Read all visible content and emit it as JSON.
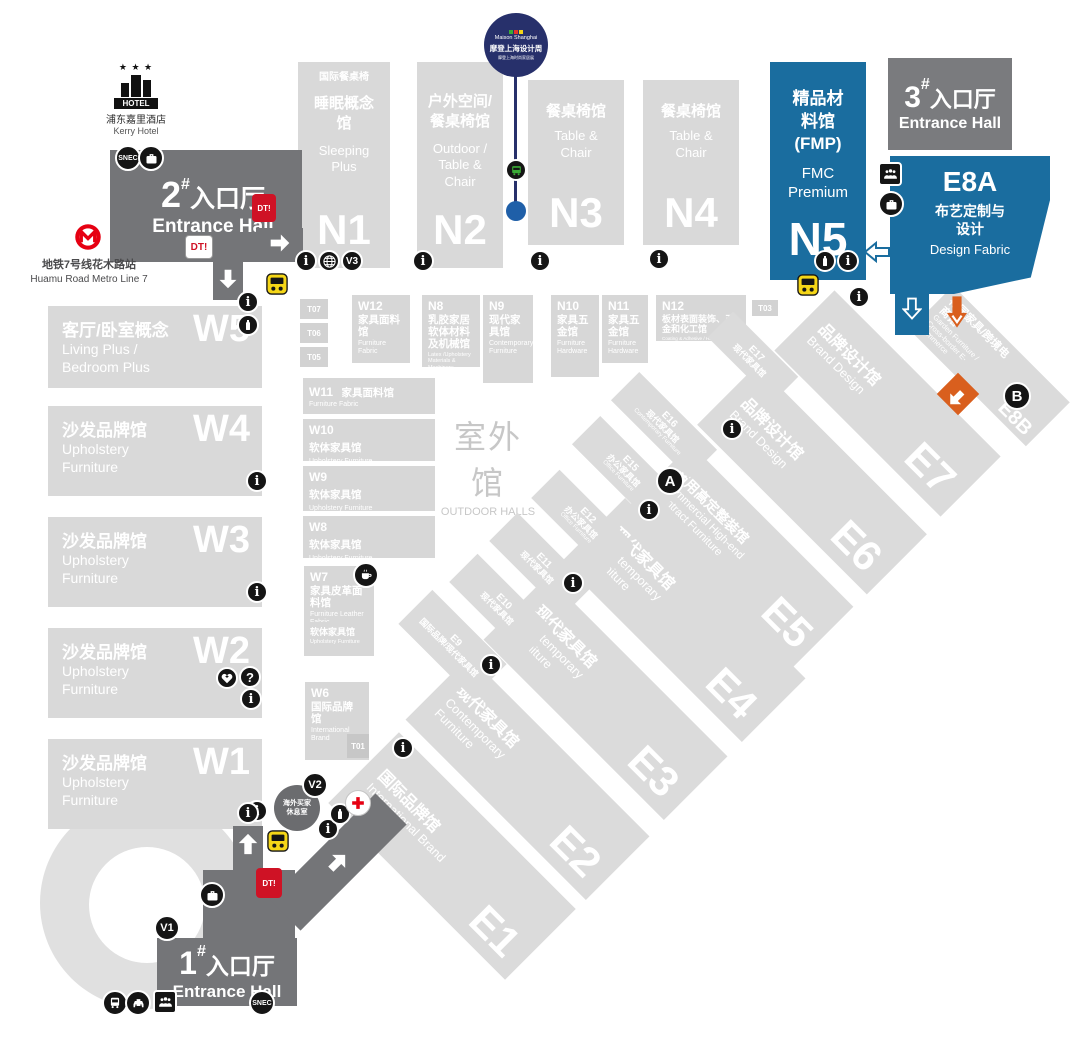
{
  "landmarks": {
    "hotel": {
      "sign": "HOTEL",
      "cn": "浦东嘉里酒店",
      "en": "Kerry Hotel"
    },
    "metro": {
      "cn": "地铁7号线花木路站",
      "en": "Huamu Road Metro Line 7"
    },
    "maison": {
      "brand": "Maison Shanghai",
      "cn": "摩登上海设计周",
      "sub": "摩登上海时尚家居展"
    },
    "outdoor": {
      "cn": "室外馆",
      "en": "OUTDOOR HALLS"
    },
    "lounge": {
      "cn": "海外买家休息室"
    }
  },
  "entrances": {
    "no1": {
      "num": "1",
      "sup": "#",
      "cn": "入口厅",
      "en": "Entrance Hall"
    },
    "no2": {
      "num": "2",
      "sup": "#",
      "cn": "入口厅",
      "en": "Entrance Hall"
    },
    "no3": {
      "num": "3",
      "sup": "#",
      "cn": "入口厅",
      "en": "Entrance Hall"
    }
  },
  "halls": {
    "W1": {
      "id": "W1",
      "cn": "沙发品牌馆",
      "en": "Upholstery Furniture"
    },
    "W2": {
      "id": "W2",
      "cn": "沙发品牌馆",
      "en": "Upholstery Furniture"
    },
    "W3": {
      "id": "W3",
      "cn": "沙发品牌馆",
      "en": "Upholstery Furniture"
    },
    "W4": {
      "id": "W4",
      "cn": "沙发品牌馆",
      "en": "Upholstery Furniture"
    },
    "W5": {
      "id": "W5",
      "cn": "客厅/卧室概念",
      "en": "Living Plus / Bedroom Plus"
    },
    "W6": {
      "id": "W6",
      "cn": "国际品牌馆",
      "en": "International Brand"
    },
    "W7": {
      "id": "W7",
      "cn": "家具皮革面料馆",
      "en": "Furniture Leather Fabric"
    },
    "W7b": {
      "cn": "软体家具馆",
      "en": "Upholstery Furniture"
    },
    "W8": {
      "id": "W8",
      "cn": "软体家具馆",
      "en": "Upholstery Furniture"
    },
    "W9": {
      "id": "W9",
      "cn": "软体家具馆",
      "en": "Upholstery Furniture"
    },
    "W10": {
      "id": "W10",
      "cn": "软体家具馆",
      "en": "Upholstery Furniture"
    },
    "W11": {
      "id": "W11",
      "cn": "家具面料馆",
      "en": "Furniture Fabric"
    },
    "W12": {
      "id": "W12",
      "cn": "家具面料馆",
      "en": "Furniture Fabric"
    },
    "N1": {
      "id": "N1",
      "top": "国际餐桌椅",
      "cn": "睡眠概念馆",
      "en": "Sleeping Plus"
    },
    "N2": {
      "id": "N2",
      "cn": "户外空间/餐桌椅馆",
      "en": "Outdoor / Table & Chair"
    },
    "N3": {
      "id": "N3",
      "cn": "餐桌椅馆",
      "en": "Table & Chair"
    },
    "N4": {
      "id": "N4",
      "cn": "餐桌椅馆",
      "en": "Table & Chair"
    },
    "N5": {
      "id": "N5",
      "cn": "精品材料馆",
      "sub": "(FMP)",
      "en": "FMC Premium"
    },
    "N8": {
      "id": "N8",
      "cn": "乳胶家居软体材料及机械馆",
      "en": "Latex /Upholstery Materials & Machinery"
    },
    "N9": {
      "id": "N9",
      "cn": "现代家具馆",
      "en": "Contemporary Furniture"
    },
    "N10": {
      "id": "N10",
      "cn": "家具五金馆",
      "en": "Furniture Hardware"
    },
    "N11": {
      "id": "N11",
      "cn": "家具五金馆",
      "en": "Furniture Hardware"
    },
    "N12": {
      "id": "N12",
      "cn": "板材表面装饰、五金和化工馆",
      "en": "Coating & Adhesive / Hardware / Panels & Surface Décor"
    },
    "E1": {
      "id": "E1",
      "cn": "国际品牌馆",
      "en": "International Brand"
    },
    "E2": {
      "id": "E2",
      "cn": "现代家具馆",
      "en": "Contemporary Furniture"
    },
    "E3": {
      "id": "E3",
      "cn": "现代家具馆",
      "en": "Contemporary Furniture"
    },
    "E4": {
      "id": "E4",
      "cn": "现代家具馆",
      "en": "Contemporary Furniture"
    },
    "E5": {
      "id": "E5",
      "cn": "商用高定整装馆",
      "en": "Commercial High-end Contract Furniture"
    },
    "E6": {
      "id": "E6",
      "cn": "品牌设计馆",
      "en": "Brand Design"
    },
    "E7": {
      "id": "E7",
      "cn": "品牌设计馆",
      "en": "Brand Design"
    },
    "E8A": {
      "id": "E8A",
      "cn": "布艺定制与设计",
      "en": "Design Fabric"
    },
    "E8B": {
      "id": "E8B",
      "cn": "花园家具/跨境电商馆",
      "en": "Garden Furniture / Cross-border E-commerce"
    },
    "E9": {
      "id": "E9",
      "cn": "国际品牌/现代家具馆",
      "en": ""
    },
    "E10": {
      "id": "E10",
      "cn": "现代家具馆",
      "en": ""
    },
    "E11": {
      "id": "E11",
      "cn": "现代家具馆",
      "en": ""
    },
    "E12": {
      "id": "E12",
      "cn": "办公家具馆",
      "en": "Office Furniture"
    },
    "E15": {
      "id": "E15",
      "cn": "办公家具馆",
      "en": "Office Furniture"
    },
    "E16": {
      "id": "E16",
      "cn": "现代家具馆",
      "en": "Contemporary Furniture"
    },
    "E17": {
      "id": "E17",
      "cn": "现代家具馆",
      "en": ""
    }
  },
  "service_boxes": {
    "t07": "T07",
    "t06": "T06",
    "t05": "T05",
    "t03": "T03",
    "t01": "T01"
  },
  "badges": {
    "snec": "SNEC",
    "dt": "DT!",
    "v1": "V1",
    "v2": "V2",
    "v3": "V3",
    "a": "A",
    "b": "B",
    "info": "i",
    "question": "?"
  },
  "colors": {
    "hall_gray": "#d9d9d9",
    "teal": "#4aa3a8",
    "blue": "#1a6d9f",
    "dark_gray": "#747578",
    "navy": "#27306b",
    "orange": "#d95f1e",
    "metro_red": "#e60012",
    "bus_yellow": "#f5d617"
  }
}
